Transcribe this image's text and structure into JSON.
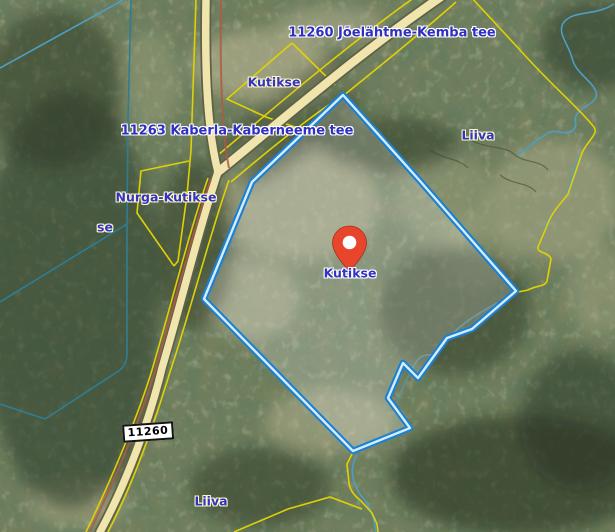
{
  "map": {
    "kind": "satellite-cadastral-map",
    "selected_parcel": "Kutikse",
    "marker": {
      "label": "Kutikse"
    },
    "labels": [
      {
        "text": "11260 Jõelähtme-Kemba tee",
        "kind": "road-name"
      },
      {
        "text": "Kutikse",
        "kind": "place-name"
      },
      {
        "text": "11263 Kaberla-Kaberneeme tee",
        "kind": "road-name"
      },
      {
        "text": "Liiva",
        "kind": "place-name"
      },
      {
        "text": "Nurga-Kutikse",
        "kind": "place-name"
      },
      {
        "text": "Kutikse",
        "kind": "marker-label"
      },
      {
        "text": "11260",
        "kind": "road-number-shield"
      },
      {
        "text": "Liiva",
        "kind": "place-name"
      },
      {
        "text": "se",
        "kind": "place-name-fragment"
      }
    ],
    "colors": {
      "label_blue": "#2f2fc1",
      "cadastral_yellow": "#e0d104",
      "road_fill": "#f1e5ae",
      "road_casing": "#5f6047",
      "road_casing_red": "#b05a44",
      "parcel_outline": "#1a80d2",
      "parcel_core": "#d6ecfb",
      "parcel_fill": "rgba(255,255,255,0.20)",
      "stream_blue": "#4e9ec4",
      "ditch_teal": "#2f7d95",
      "marker_red": "#e8462c",
      "shield_border": "#141414"
    }
  }
}
